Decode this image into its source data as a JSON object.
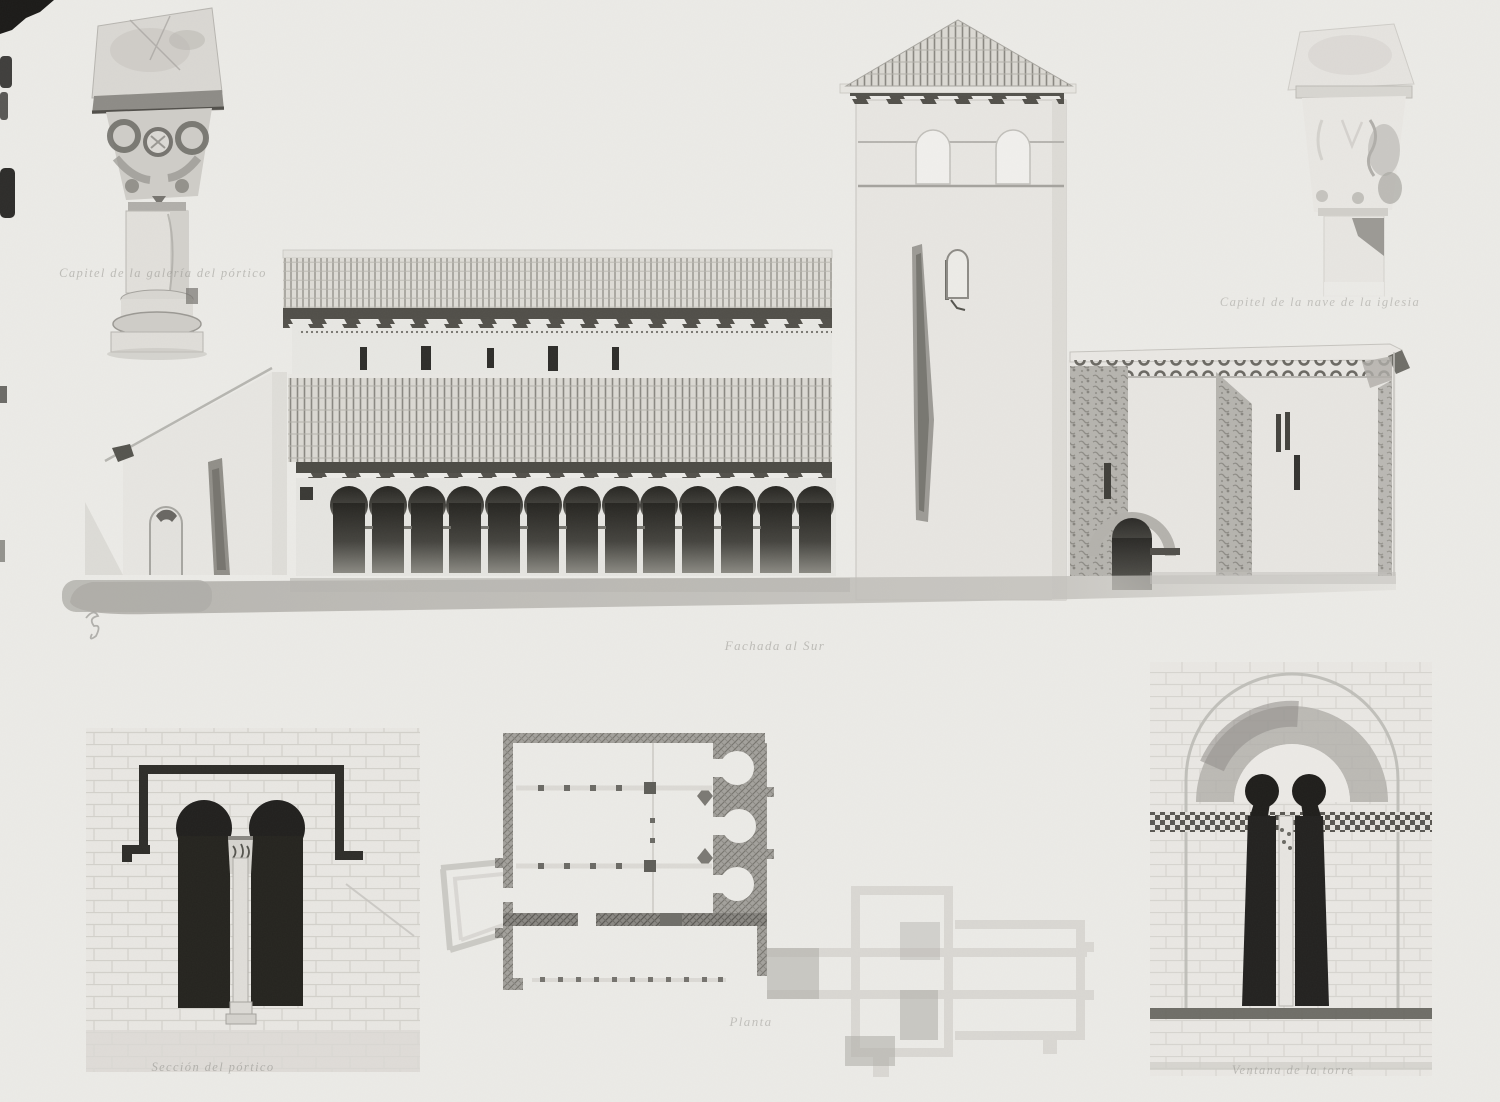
{
  "plate": {
    "type": "scanned architectural plate",
    "paper_color": "#ecebe7",
    "ink_color": "#22211f",
    "captions": {
      "capital_left": "Capitel de la galería del pórtico",
      "capital_right": "Capitel de la nave de la iglesia",
      "elevation": "Fachada al Sur",
      "portico_window": "Sección del pórtico",
      "plan": "Planta",
      "tower_window": "Ventana de la torre"
    },
    "figures": [
      {
        "id": "capital-left-figure",
        "caption_key": "capital_left"
      },
      {
        "id": "church-elevation-figure",
        "caption_key": "elevation"
      },
      {
        "id": "capital-right-figure",
        "caption_key": "capital_right"
      },
      {
        "id": "portico-window-figure",
        "caption_key": "portico_window"
      },
      {
        "id": "floor-plan-figure",
        "caption_key": "plan"
      },
      {
        "id": "tower-window-figure",
        "caption_key": "tower_window"
      }
    ]
  }
}
